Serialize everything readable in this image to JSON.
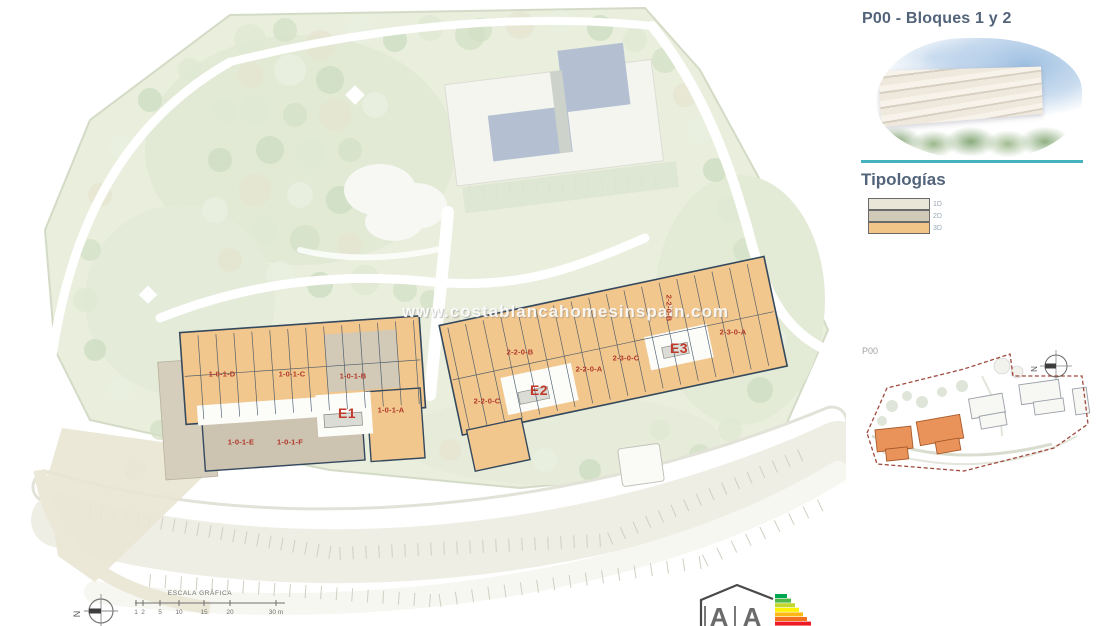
{
  "side_panel": {
    "title": "P00 - Bloques 1 y 2",
    "typologies_title": "Tipologías",
    "legend": [
      {
        "label": "1D",
        "color": "#eae6d7"
      },
      {
        "label": "2D",
        "color": "#d2cab9"
      },
      {
        "label": "3D",
        "color": "#f1c487"
      }
    ],
    "minimap": {
      "plan_label": "P00",
      "north_label": "N"
    }
  },
  "site_plan": {
    "watermark": "www.costablancahomesinspain.com",
    "block_labels": [
      {
        "text": "1-0-1-D"
      },
      {
        "text": "1-0-1-C"
      },
      {
        "text": "1-0-1-B"
      },
      {
        "text": "1-0-1-A"
      },
      {
        "text": "E1"
      },
      {
        "text": "1-0-1-E"
      },
      {
        "text": "1-0-1-F"
      },
      {
        "text": "2-2-0-C"
      },
      {
        "text": "E2"
      },
      {
        "text": "2-2-0-B"
      },
      {
        "text": "2-2-0-A"
      },
      {
        "text": "2-3-0-C"
      },
      {
        "text": "E3"
      },
      {
        "text": "2-2-0-B"
      },
      {
        "text": "2-3-0-A"
      }
    ],
    "scale_bar": {
      "title": "ESCALA GRÁFICA",
      "ticks": [
        "1",
        "2",
        "5",
        "10",
        "15",
        "20",
        "30 m"
      ],
      "north_label": "N"
    },
    "energy_badge": {
      "letters": [
        "A",
        "A"
      ],
      "scale_colors": [
        "#00a651",
        "#50b848",
        "#bfd730",
        "#fff200",
        "#fdb913",
        "#f37021",
        "#ed1c24"
      ]
    }
  }
}
